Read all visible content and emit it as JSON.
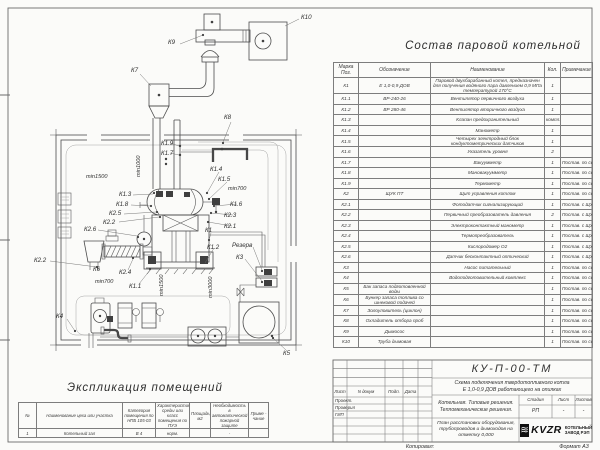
{
  "parts_table": {
    "title": "Состав паровой котельной",
    "headers": [
      "Марка Поз.",
      "Обозначение",
      "Наименование",
      "Кол.",
      "Примечание"
    ],
    "rows": [
      [
        "К1",
        "Е 1,0-0,9 ДОВ",
        "Паровой двухбарабанный котел, предназначен для получения водяного пара давлением 0,9 МПа температурой 170°С",
        "1",
        ""
      ],
      [
        "К1.1",
        "ВР-240-26",
        "Вентилятор первичного воздуха",
        "1",
        ""
      ],
      [
        "К1.2",
        "ВР 280-46",
        "Вентилятор вторичного воздуха",
        "1",
        ""
      ],
      [
        "К1.3",
        "",
        "Клапан предохранительный",
        "компл.",
        ""
      ],
      [
        "К1.4",
        "",
        "Манометр",
        "1",
        ""
      ],
      [
        "К1.5",
        "",
        "Четырех электродный блок кондуктометрических датчиков",
        "1",
        ""
      ],
      [
        "К1.6",
        "",
        "Указатель уровня",
        "2",
        ""
      ],
      [
        "К1.7",
        "",
        "Вакуумметр",
        "1",
        "Постав. по согласов."
      ],
      [
        "К1.8",
        "",
        "Мановакуумметр",
        "1",
        "Постав. по согласов."
      ],
      [
        "К1.9",
        "",
        "Термометр",
        "1",
        "Постав. по согласов."
      ],
      [
        "К2",
        "ЩУК ПТ",
        "Щит управления котлом",
        "1",
        "Постав. по согласов."
      ],
      [
        "К2.1",
        "",
        "Фотодатчик сигнализирующий",
        "1",
        "Постав. с ЩУК ПТ"
      ],
      [
        "К2.2",
        "",
        "Первичный преобразователь давления",
        "2",
        "Постав. с ЩУК ПТ"
      ],
      [
        "К2.3",
        "",
        "Электроконтактный манометр",
        "1",
        "Постав. с ЩУК ПТ"
      ],
      [
        "К2.4",
        "",
        "Термопреобразователь",
        "1",
        "Постав. с ЩУК ПТ"
      ],
      [
        "К2.5",
        "",
        "Кислородомер О2",
        "1",
        "Постав. с ЩУК ПТ"
      ],
      [
        "К2.6",
        "",
        "Датчик бесконтактный оптический",
        "1",
        "Постав. с ЩУК ПТ"
      ],
      [
        "К3",
        "",
        "Насос питательный",
        "1",
        "Постав. по согласов."
      ],
      [
        "К4",
        "",
        "Водоподготовительный комплекс",
        "1",
        "Постав. по согласов."
      ],
      [
        "К5",
        "Бак запаса подготовленной воды",
        "",
        "1",
        "Постав. по согласов."
      ],
      [
        "К6",
        "Бункер запаса топлива со шнековой подачей",
        "",
        "1",
        "Постав. по согласов."
      ],
      [
        "К7",
        "Золоуловитель (циклон)",
        "",
        "1",
        "Постав. по согласов."
      ],
      [
        "К8",
        "Охладитель отбора проб",
        "",
        "1",
        "Постав. по согласов."
      ],
      [
        "К9",
        "Дымосос",
        "",
        "1",
        "Постав. по согласов."
      ],
      [
        "К10",
        "Труба дымовая",
        "",
        "1",
        "Постав. по согласов."
      ]
    ]
  },
  "explication": {
    "title": "Экспликация помещений",
    "headers": [
      "№",
      "Наименование цеха или участка",
      "Категория помещения по НПБ 105-03",
      "Характеристика среды или класс помещения по ПУЭ",
      "Площадь, м2",
      "Необходимость в автоматической пожарной защите",
      "Приме - чание"
    ],
    "rows": [
      [
        "1",
        "Котельный зал",
        "В 4",
        "норм.",
        "",
        "-",
        ""
      ]
    ]
  },
  "title_block": {
    "code": "КУ-П-00-ТМ",
    "doc_title_line1": "Схема подключения твердотопливного котла",
    "doc_title_line2": "Е 1,0-0,9 ДОВ работающего на опилках",
    "object": "Котельная. Типовые решения. Тепломеханические решения.",
    "sheet_title": "План расстановки оборудования, трубопроводов и дымоходов на отметку 0,000",
    "cols": {
      "sheet": "Лист",
      "doc": "N докум",
      "sign": "Подп.",
      "date": "Дата"
    },
    "roles": [
      "Проект.",
      "Проверил",
      "ГИП"
    ],
    "stage_label": "Стадия",
    "sheet_label": "Лист",
    "sheets_label": "Листов",
    "stage": "РП",
    "sheet_no": "-",
    "sheets": "-",
    "logo_glyph": "≋",
    "logo_text": "KVZR",
    "company_line1": "КОТЕЛЬНЫЙ",
    "company_line2": "ЗАВОД РЭП"
  },
  "footer": {
    "copied": "Копировал:",
    "format": "Формат А3"
  },
  "diagram": {
    "labels": [
      {
        "t": "К10",
        "x": 301,
        "y": 19
      },
      {
        "t": "К9",
        "x": 168,
        "y": 44
      },
      {
        "t": "К7",
        "x": 131,
        "y": 72
      },
      {
        "t": "К8",
        "x": 224,
        "y": 119
      },
      {
        "t": "К1.9",
        "x": 161,
        "y": 145
      },
      {
        "t": "К1.7",
        "x": 161,
        "y": 155
      },
      {
        "t": "К1.4",
        "x": 210,
        "y": 171
      },
      {
        "t": "К1.5",
        "x": 218,
        "y": 181
      },
      {
        "t": "К1.6",
        "x": 230,
        "y": 206
      },
      {
        "t": "К2.3",
        "x": 224,
        "y": 217
      },
      {
        "t": "К2.1",
        "x": 224,
        "y": 228
      },
      {
        "t": "К1",
        "x": 205,
        "y": 232
      },
      {
        "t": "К1.3",
        "x": 119,
        "y": 196
      },
      {
        "t": "К1.8",
        "x": 116,
        "y": 206
      },
      {
        "t": "К2.5",
        "x": 109,
        "y": 215
      },
      {
        "t": "К2.2",
        "x": 103,
        "y": 224
      },
      {
        "t": "К2.6",
        "x": 84,
        "y": 231
      },
      {
        "t": "К2.2",
        "x": 34,
        "y": 262
      },
      {
        "t": "К6",
        "x": 93,
        "y": 271
      },
      {
        "t": "К2.4",
        "x": 119,
        "y": 274
      },
      {
        "t": "К1.1",
        "x": 129,
        "y": 288
      },
      {
        "t": "К1.2",
        "x": 207,
        "y": 249
      },
      {
        "t": "Резерв",
        "x": 232,
        "y": 247
      },
      {
        "t": "К3",
        "x": 236,
        "y": 259
      },
      {
        "t": "К4",
        "x": 56,
        "y": 318
      },
      {
        "t": "К5",
        "x": 283,
        "y": 355
      },
      {
        "t": "min1000",
        "x": 140,
        "y": 177,
        "rot": 1,
        "dim": 1
      },
      {
        "t": "min1500",
        "x": 86,
        "y": 178,
        "dim": 1
      },
      {
        "t": "min700",
        "x": 228,
        "y": 190,
        "dim": 1
      },
      {
        "t": "min700",
        "x": 95,
        "y": 283,
        "dim": 1
      },
      {
        "t": "min1500",
        "x": 163,
        "y": 296,
        "rot": 1,
        "dim": 1
      },
      {
        "t": "min3000",
        "x": 212,
        "y": 298,
        "rot": 1,
        "dim": 1
      }
    ]
  }
}
